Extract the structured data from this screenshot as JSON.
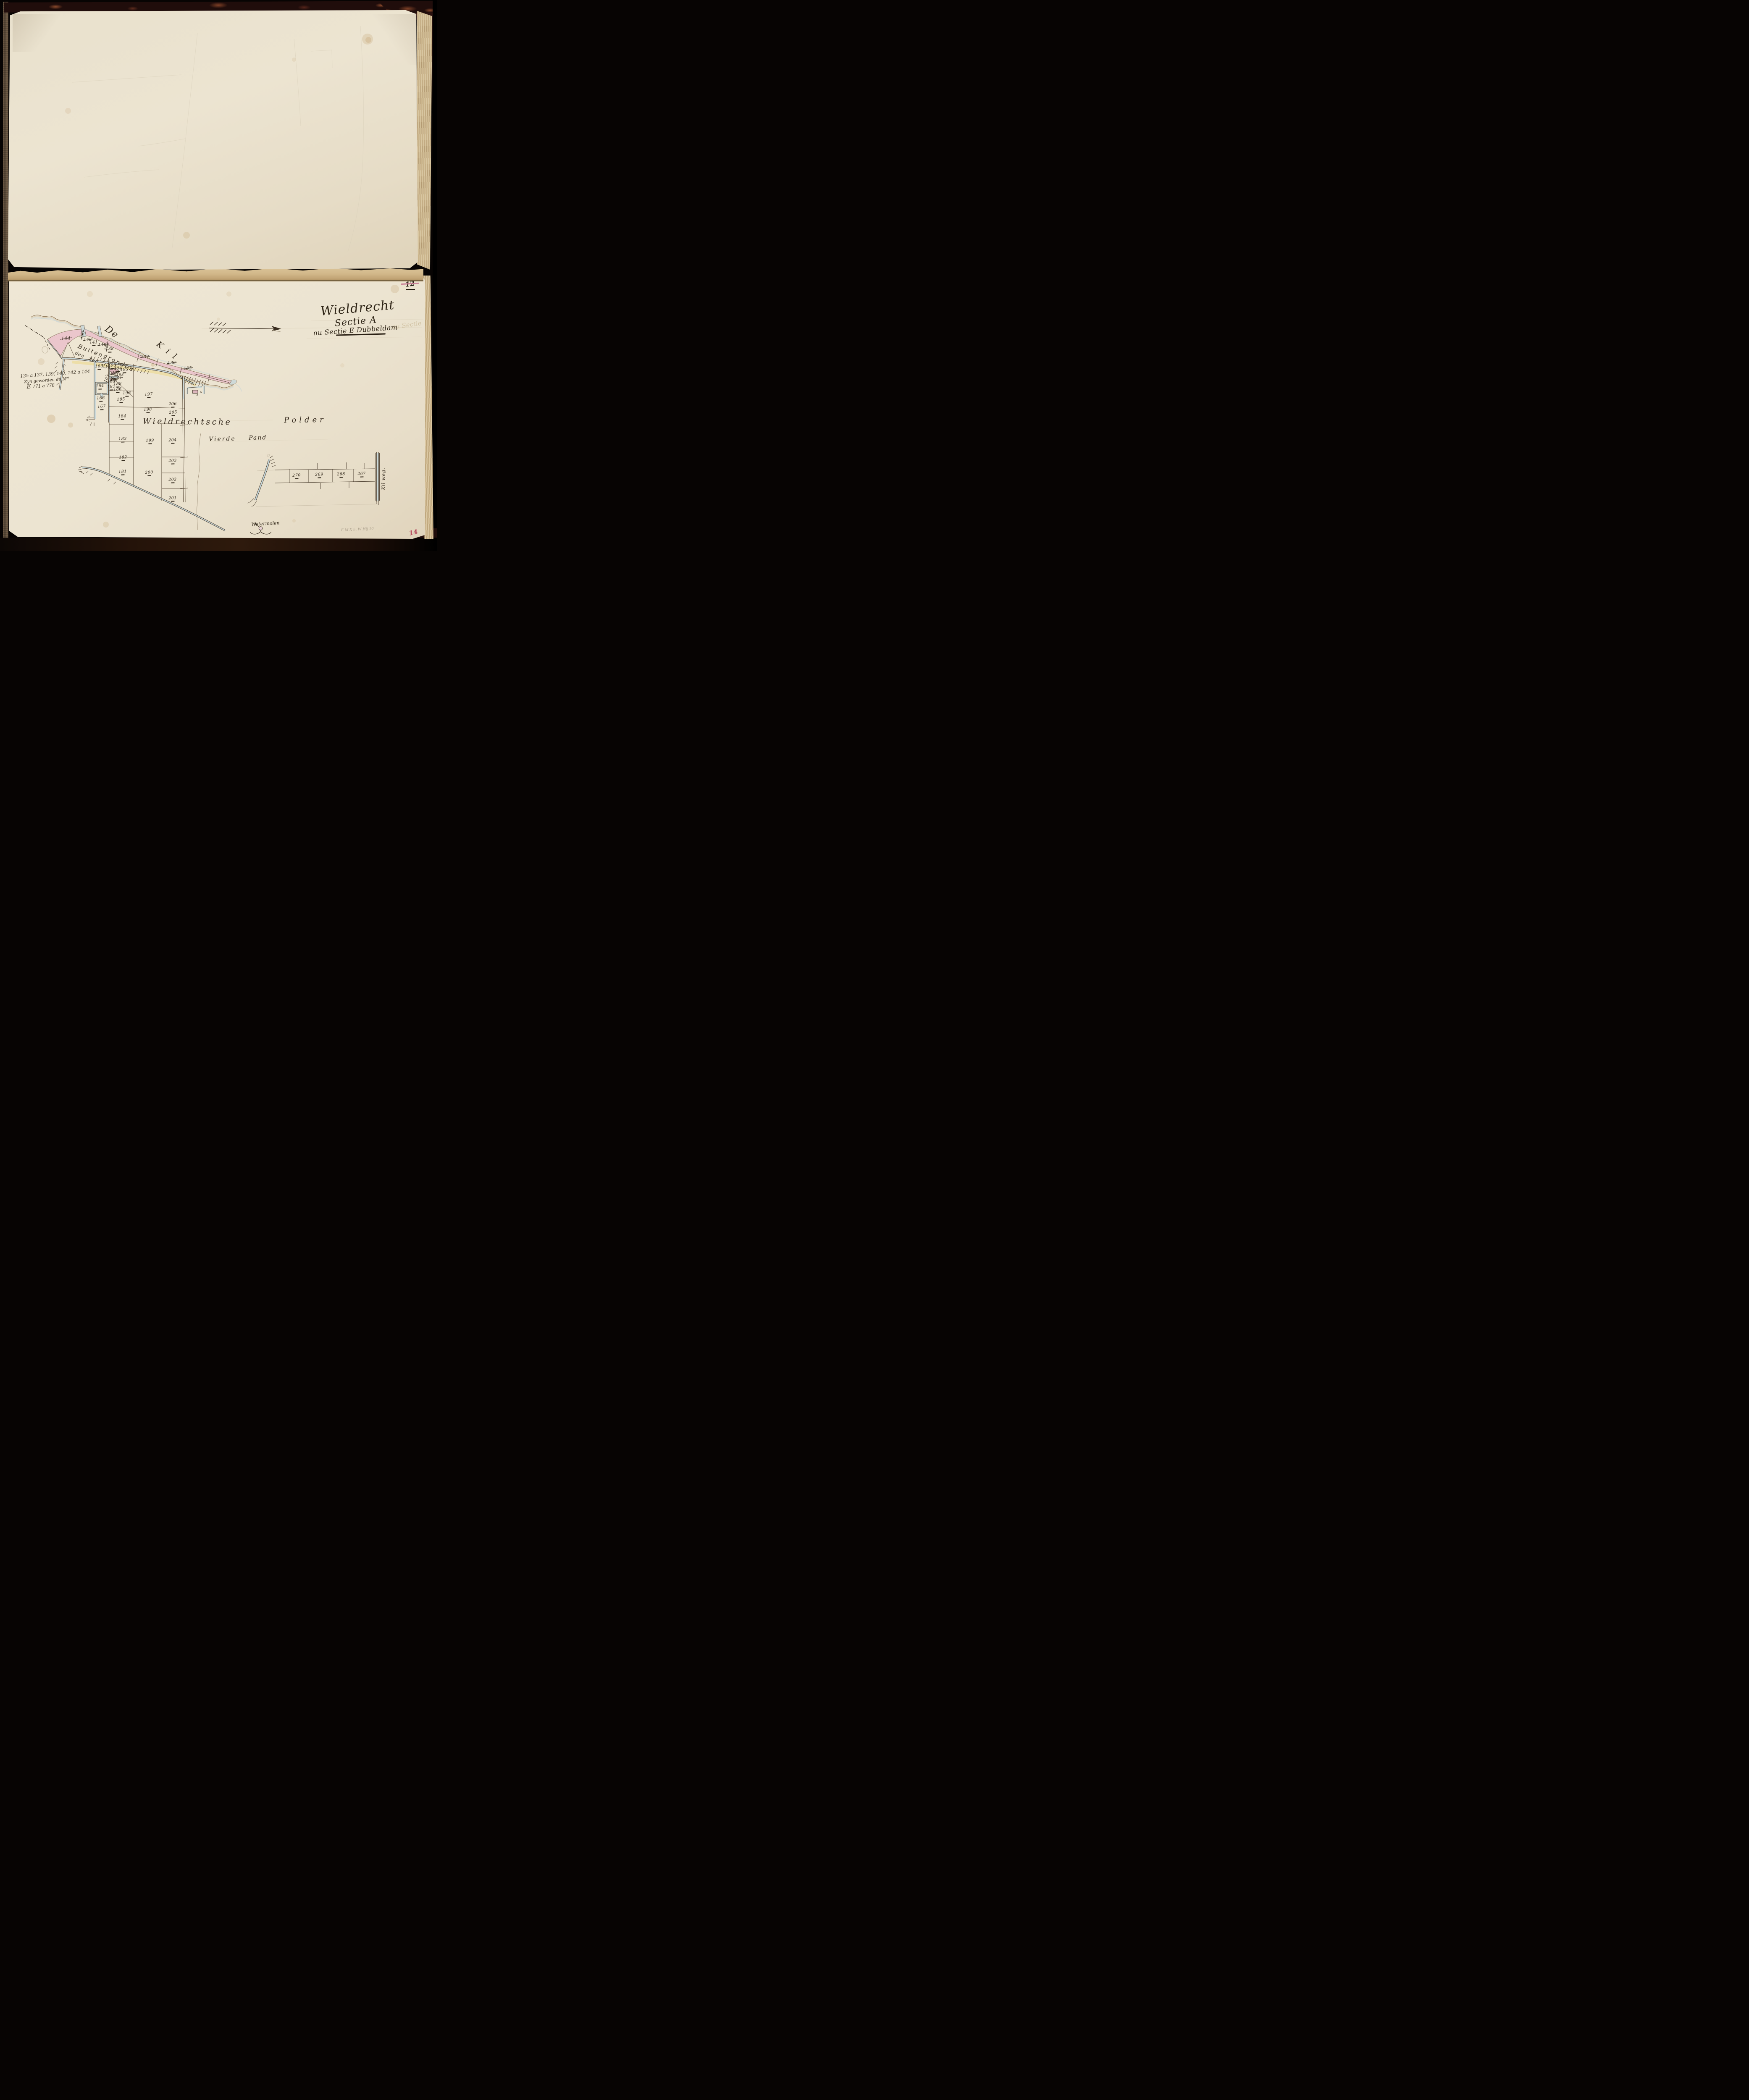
{
  "page": {
    "top_page_number": "12",
    "bottom_page_number": "14",
    "pencil_annotation": "E M X h. W Hij 10"
  },
  "title": {
    "place": "Wieldrecht",
    "section": "Sectie A",
    "revision": "nu Sectie E Dubbeldam",
    "ghost": "nu Sectie"
  },
  "marginal_note": {
    "line1": "135 a 137, 139, 140, 142 a 144",
    "line2_main": "Zyn geworden de N",
    "line2_sup": "os",
    "line3_initial": "E",
    "line3_numbers": "771 a 778"
  },
  "map": {
    "labels": {
      "river_1": "De",
      "river_2": "Kil",
      "buiten_1": "Buiten",
      "buiten_2": "gronden",
      "dyke": "den Zee dyk",
      "polder_1": "Wieldrechtsche",
      "polder_2": "Polder",
      "pand_1": "Vierde",
      "pand_2": "Pand",
      "road": "Kil weg.",
      "mill": "Watermolen"
    },
    "buiten": [
      {
        "n": "144",
        "struck": true
      },
      {
        "n": "143",
        "struck": true
      },
      {
        "n": "142",
        "struck": true
      },
      {
        "n": "141",
        "struck": false
      },
      {
        "n": "140",
        "struck": true
      },
      {
        "n": "139",
        "struck": true
      },
      {
        "n": "138",
        "struck": false
      },
      {
        "n": "137",
        "struck": true
      },
      {
        "n": "136",
        "struck": true
      },
      {
        "n": "135",
        "struck": true
      }
    ],
    "village": [
      {
        "n": "163"
      },
      {
        "n": "193"
      },
      {
        "n": "194"
      },
      {
        "n": "195"
      },
      {
        "n": "197"
      },
      {
        "n": "192",
        "struck": true
      },
      {
        "n": "198"
      },
      {
        "n": "191",
        "struck": true
      },
      {
        "n": "190",
        "struck": true
      },
      {
        "n": "189"
      },
      {
        "n": "188"
      },
      {
        "n": "187"
      },
      {
        "n": "186"
      },
      {
        "n": "165"
      },
      {
        "n": "164"
      },
      {
        "n": "166"
      },
      {
        "n": "167"
      }
    ],
    "fields": [
      {
        "n": "196"
      },
      {
        "n": "197"
      },
      {
        "n": "206"
      },
      {
        "n": "198"
      },
      {
        "n": "205"
      },
      {
        "n": "185"
      },
      {
        "n": "184"
      },
      {
        "n": "183"
      },
      {
        "n": "182"
      },
      {
        "n": "181"
      },
      {
        "n": "199"
      },
      {
        "n": "200"
      },
      {
        "n": "204"
      },
      {
        "n": "203"
      },
      {
        "n": "202"
      },
      {
        "n": "201"
      }
    ],
    "strip": [
      {
        "n": "270"
      },
      {
        "n": "269"
      },
      {
        "n": "268"
      },
      {
        "n": "267"
      }
    ]
  }
}
